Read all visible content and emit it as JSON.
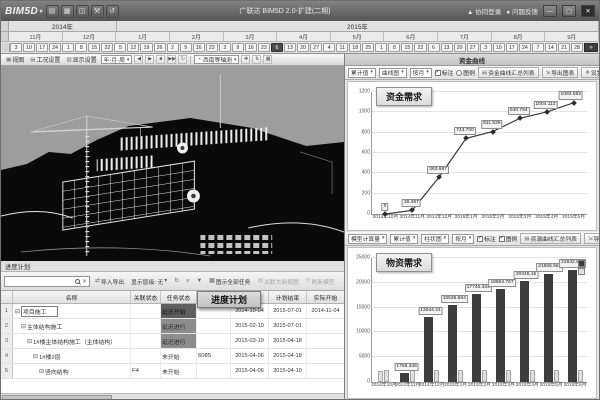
{
  "titlebar": {
    "logo": "BIM5D",
    "logo_caret": "▾",
    "icons": [
      "▤",
      "▦",
      "◫",
      "⚒",
      "↺"
    ],
    "title": "广联达 BIM5D 2.0-扩建(二期)",
    "login": "▲ 协同登录",
    "feedback": "● 问题反馈",
    "minimize": "—",
    "maximize": "▢",
    "close": "✕"
  },
  "timeline": {
    "years": [
      {
        "label": "2014年",
        "span": 8
      },
      {
        "label": "2015年",
        "span": 36
      }
    ],
    "months": [
      {
        "label": "11月",
        "days": [
          3,
          10,
          17,
          24
        ]
      },
      {
        "label": "12月",
        "days": [
          1,
          8,
          15,
          22
        ]
      },
      {
        "label": "1月",
        "days": [
          5,
          12,
          19,
          26
        ]
      },
      {
        "label": "2月",
        "days": [
          2,
          9,
          16,
          23
        ]
      },
      {
        "label": "3月",
        "days": [
          2,
          9,
          16,
          23
        ]
      },
      {
        "label": "4月",
        "days": [
          6,
          13,
          20,
          27
        ]
      },
      {
        "label": "5月",
        "days": [
          4,
          11,
          18,
          25
        ]
      },
      {
        "label": "6月",
        "days": [
          1,
          8,
          15,
          22
        ]
      },
      {
        "label": "7月",
        "days": [
          6,
          13,
          20,
          27
        ]
      },
      {
        "label": "8月",
        "days": [
          3,
          10,
          17,
          24
        ]
      },
      {
        "label": "9月",
        "days": [
          7,
          14,
          21,
          28
        ]
      }
    ],
    "selected": {
      "month": 5,
      "day": 0
    },
    "scroll_end": "»"
  },
  "viewer_toolbar": {
    "buttons": [
      {
        "icon": "▦",
        "label": "视图"
      },
      {
        "icon": "▤",
        "label": "工况设置"
      },
      {
        "icon": "▥",
        "label": "显示设置"
      }
    ],
    "time_scale": "年-月-周",
    "play_icons": [
      "◀",
      "▶",
      "■",
      "▶▶",
      "↻"
    ],
    "view_mode": "西南等轴测",
    "view_mode_icon": "◔",
    "extra_icons": [
      "✥",
      "⇅",
      "▦"
    ]
  },
  "funds_panel": {
    "header": "资金曲线",
    "selects": [
      "累计值",
      "曲线图",
      "按月"
    ],
    "toggles": [
      {
        "label": "标注",
        "type": "checkbox",
        "checked": true
      },
      {
        "label": "图例",
        "type": "radio",
        "checked": false
      }
    ],
    "buttons": [
      {
        "icon": "▤",
        "label": "资金曲线汇总列表"
      },
      {
        "icon": "⇲",
        "label": "导出图表"
      },
      {
        "icon": "✲",
        "label": "设置"
      }
    ]
  },
  "materials_panel": {
    "selects": [
      "模型计算量",
      "累计值",
      "柱状图",
      "按月"
    ],
    "toggles": [
      {
        "label": "标注",
        "type": "checkbox",
        "checked": true
      },
      {
        "label": "图例",
        "type": "checkbox",
        "checked": true
      }
    ],
    "buttons": [
      {
        "icon": "▤",
        "label": "资源曲线汇总列表"
      },
      {
        "icon": "⇲",
        "label": "导出图表"
      }
    ]
  },
  "chart_data": [
    {
      "type": "line",
      "title": "资金需求",
      "x": [
        "2014年10月",
        "2014年11月",
        "2014年12月",
        "2015年1月",
        "2015年2月",
        "2015年3月",
        "2015年4月",
        "2015年5月"
      ],
      "values": [
        0,
        36.487,
        363.687,
        743.7,
        811.526,
        940.794,
        1004.113,
        1093.592
      ],
      "point_labels": [
        "0",
        "36.487",
        "363.687",
        "743.700",
        "811.526",
        "940.794",
        "1004.113",
        "1093.592"
      ],
      "xlabel": "",
      "ylabel": "",
      "ylim": [
        0,
        1200
      ],
      "yticks": [
        0,
        200,
        400,
        600,
        800,
        1000,
        1200
      ],
      "grid": true,
      "legend": "none"
    },
    {
      "type": "bar",
      "title": "物资需求",
      "categories": [
        "2014年10月",
        "2014年11月",
        "2014年12月",
        "2015年1月",
        "2015年2月",
        "2015年3月",
        "2015年4月",
        "2015年5月",
        "2015年6月"
      ],
      "series": [
        {
          "name": "累计量",
          "values": [
            2300,
            1768.345,
            13044.41,
            15536.584,
            17746.434,
            18664.767,
            20346.15,
            21865.563,
            22632.804
          ],
          "labels": [
            "",
            "1768.345",
            "13044.41",
            "15536.584",
            "17746.434",
            "18664.767",
            "20346.15",
            "21865.563",
            "22632.804"
          ]
        },
        {
          "name": "当期量",
          "values": [
            2400,
            2400,
            2400,
            2400,
            2400,
            2400,
            2400,
            2400,
            2400
          ],
          "labels": [
            "",
            "",
            "",
            "",
            "",
            "",
            "",
            "",
            ""
          ]
        }
      ],
      "xlabel": "",
      "ylabel": "",
      "ylim": [
        0,
        25000
      ],
      "yticks": [
        0,
        5000,
        10000,
        15000,
        20000,
        25000
      ],
      "grid": true,
      "legend": "top-right"
    }
  ],
  "schedule": {
    "panel_title": "进度计划",
    "floating_tab": "进度计划",
    "toolbar": {
      "search_placeholder": "",
      "buttons": [
        {
          "icon": "⇄",
          "label": "导入导出"
        },
        {
          "icon": "",
          "label": "显示层级: 无",
          "dropdown": true
        },
        {
          "icon": "↻",
          "label": ""
        },
        {
          "icon": "≡",
          "label": ""
        },
        {
          "icon": "▼",
          "label": ""
        },
        {
          "icon": "▦",
          "label": "图示全部任务"
        },
        {
          "icon": "▤",
          "label": "关联大纲视图",
          "disabled": true
        },
        {
          "icon": "⟳",
          "label": "刷新模型",
          "disabled": true
        }
      ]
    },
    "columns": [
      {
        "key": "no",
        "label": "",
        "w": 12
      },
      {
        "key": "name",
        "label": "名称",
        "w": 118
      },
      {
        "key": "link",
        "label": "关联状态",
        "w": 30
      },
      {
        "key": "status",
        "label": "任务状态",
        "w": 36
      },
      {
        "key": "extra",
        "label": "",
        "w": 34
      },
      {
        "key": "plan_start",
        "label": "计划开始",
        "w": 38
      },
      {
        "key": "plan_end",
        "label": "计划结束",
        "w": 38
      },
      {
        "key": "actual_start",
        "label": "实际开始",
        "w": 38
      }
    ],
    "rows": [
      {
        "no": "1",
        "indent": 0,
        "expander": "⊟",
        "name": "项目施工",
        "link": "",
        "status": "延迟开始",
        "status_style": "dark1",
        "extra": "",
        "plan_start": "2014-10-04",
        "plan_end": "2015-07-01",
        "actual_start": "2014-11-04",
        "name_boxed": true
      },
      {
        "no": "2",
        "indent": 1,
        "expander": "⊟",
        "name": "主体结构施工",
        "link": "",
        "status": "延迟进行",
        "status_style": "dark2",
        "extra": "",
        "plan_start": "2015-02-10",
        "plan_end": "2015-07-01",
        "actual_start": ""
      },
      {
        "no": "3",
        "indent": 2,
        "expander": "⊟",
        "name": "1#楼主体结构施工（主体结构）",
        "link": "",
        "status": "延迟进行",
        "status_style": "dark2",
        "extra": "",
        "plan_start": "2015-03-19",
        "plan_end": "2015-04-18",
        "actual_start": ""
      },
      {
        "no": "4",
        "indent": 3,
        "expander": "⊟",
        "name": "1#楼2层",
        "link": "",
        "status": "未开始",
        "status_style": "plain",
        "extra": "6085",
        "plan_start": "2015-04-06",
        "plan_end": "2015-04-18",
        "actual_start": ""
      },
      {
        "no": "5",
        "indent": 4,
        "expander": "⊟",
        "name": "竖向结构",
        "link": "F4",
        "status": "未开始",
        "status_style": "plain",
        "extra": "",
        "plan_start": "2015-04-06",
        "plan_end": "2015-04-10",
        "actual_start": ""
      }
    ]
  },
  "colors": {
    "bar_dark": "#3d3d3d",
    "bar_light": "#e0e0e0",
    "line": "#383838",
    "grid": "#e4e4e4",
    "status_dark1": "#5f5f5f",
    "status_dark2": "#8d8d8d"
  }
}
